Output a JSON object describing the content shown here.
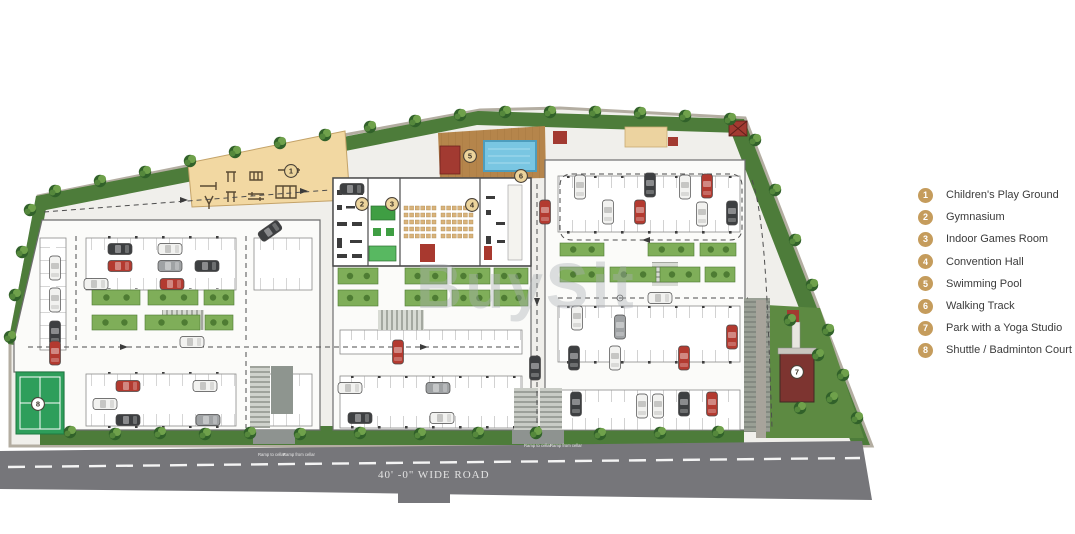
{
  "watermark": {
    "text": "BuySit"
  },
  "road": {
    "label": "40' -0\" WIDE ROAD",
    "ramp_to": "Ramp to cellar",
    "ramp_from": "Ramp from cellar"
  },
  "legend": {
    "circle_color": "#c59c5c",
    "items": [
      {
        "num": "1",
        "label": "Children's Play Ground"
      },
      {
        "num": "2",
        "label": "Gymnasium"
      },
      {
        "num": "3",
        "label": "Indoor Games Room"
      },
      {
        "num": "4",
        "label": "Convention Hall"
      },
      {
        "num": "5",
        "label": "Swimming Pool"
      },
      {
        "num": "6",
        "label": "Walking Track"
      },
      {
        "num": "7",
        "label": "Park with a Yoga Studio"
      },
      {
        "num": "8",
        "label": "Shuttle / Badminton Court"
      }
    ]
  },
  "plan": {
    "markers": [
      {
        "n": "1",
        "x": 291,
        "y": 171,
        "s": "g"
      },
      {
        "n": "2",
        "x": 362,
        "y": 204,
        "s": "g"
      },
      {
        "n": "3",
        "x": 392,
        "y": 204,
        "s": "g"
      },
      {
        "n": "4",
        "x": 472,
        "y": 205,
        "s": "g"
      },
      {
        "n": "5",
        "x": 470,
        "y": 156,
        "s": "g"
      },
      {
        "n": "6",
        "x": 521,
        "y": 176,
        "s": "g"
      },
      {
        "n": "7",
        "x": 797,
        "y": 372,
        "s": "w"
      },
      {
        "n": "8",
        "x": 38,
        "y": 404,
        "s": "w"
      }
    ],
    "cars": [
      [
        120,
        249,
        0,
        "dark"
      ],
      [
        120,
        266,
        0,
        "red"
      ],
      [
        96,
        284,
        0,
        "white"
      ],
      [
        170,
        249,
        0,
        "white"
      ],
      [
        170,
        266,
        0,
        "gray"
      ],
      [
        207,
        266,
        0,
        "dark"
      ],
      [
        172,
        284,
        0,
        "red"
      ],
      [
        55,
        268,
        90,
        "white"
      ],
      [
        55,
        300,
        90,
        "white"
      ],
      [
        55,
        333,
        90,
        "dark"
      ],
      [
        55,
        353,
        90,
        "red"
      ],
      [
        128,
        386,
        0,
        "red"
      ],
      [
        105,
        404,
        0,
        "white"
      ],
      [
        128,
        420,
        0,
        "dark"
      ],
      [
        205,
        386,
        0,
        "white"
      ],
      [
        208,
        420,
        0,
        "gray"
      ],
      [
        270,
        231,
        -35,
        "dark"
      ],
      [
        192,
        342,
        0,
        "white"
      ],
      [
        352,
        189,
        0,
        "dark"
      ],
      [
        398,
        352,
        90,
        "red"
      ],
      [
        350,
        388,
        0,
        "white"
      ],
      [
        438,
        388,
        0,
        "gray"
      ],
      [
        360,
        418,
        0,
        "dark"
      ],
      [
        442,
        418,
        0,
        "white"
      ],
      [
        535,
        368,
        90,
        "dark"
      ],
      [
        580,
        187,
        90,
        "white"
      ],
      [
        650,
        185,
        90,
        "dark"
      ],
      [
        685,
        187,
        90,
        "white"
      ],
      [
        707,
        186,
        90,
        "red"
      ],
      [
        545,
        212,
        90,
        "red"
      ],
      [
        608,
        212,
        90,
        "white"
      ],
      [
        640,
        212,
        90,
        "red"
      ],
      [
        702,
        214,
        90,
        "white"
      ],
      [
        732,
        213,
        90,
        "dark"
      ],
      [
        577,
        318,
        90,
        "white"
      ],
      [
        620,
        327,
        90,
        "gray"
      ],
      [
        615,
        358,
        90,
        "white"
      ],
      [
        574,
        358,
        90,
        "dark"
      ],
      [
        684,
        358,
        90,
        "red"
      ],
      [
        732,
        337,
        90,
        "red"
      ],
      [
        660,
        298,
        0,
        "white"
      ],
      [
        576,
        404,
        90,
        "dark"
      ],
      [
        642,
        406,
        90,
        "white"
      ],
      [
        658,
        406,
        90,
        "white"
      ],
      [
        684,
        404,
        90,
        "dark"
      ],
      [
        712,
        404,
        90,
        "red"
      ]
    ],
    "trees": [
      [
        55,
        191
      ],
      [
        100,
        181
      ],
      [
        145,
        172
      ],
      [
        190,
        161
      ],
      [
        235,
        152
      ],
      [
        280,
        143
      ],
      [
        325,
        135
      ],
      [
        370,
        127
      ],
      [
        415,
        121
      ],
      [
        460,
        115
      ],
      [
        505,
        112
      ],
      [
        550,
        112
      ],
      [
        595,
        112
      ],
      [
        640,
        113
      ],
      [
        685,
        116
      ],
      [
        730,
        119
      ],
      [
        30,
        210
      ],
      [
        22,
        252
      ],
      [
        15,
        295
      ],
      [
        10,
        337
      ],
      [
        755,
        140
      ],
      [
        775,
        190
      ],
      [
        795,
        240
      ],
      [
        812,
        285
      ],
      [
        828,
        330
      ],
      [
        843,
        375
      ],
      [
        857,
        418
      ],
      [
        790,
        320
      ],
      [
        818,
        355
      ],
      [
        800,
        408
      ],
      [
        832,
        398
      ],
      [
        70,
        432
      ],
      [
        115,
        434
      ],
      [
        160,
        433
      ],
      [
        205,
        434
      ],
      [
        250,
        433
      ],
      [
        300,
        434
      ],
      [
        360,
        433
      ],
      [
        420,
        434
      ],
      [
        478,
        433
      ],
      [
        536,
        433
      ],
      [
        600,
        434
      ],
      [
        660,
        433
      ],
      [
        718,
        432
      ]
    ],
    "planters": [
      [
        92,
        290,
        48,
        15
      ],
      [
        148,
        290,
        50,
        15
      ],
      [
        204,
        290,
        30,
        15
      ],
      [
        92,
        315,
        45,
        15
      ],
      [
        145,
        315,
        55,
        15
      ],
      [
        205,
        315,
        28,
        15
      ],
      [
        338,
        268,
        40,
        16
      ],
      [
        338,
        290,
        40,
        16
      ],
      [
        405,
        268,
        42,
        16
      ],
      [
        452,
        268,
        38,
        16
      ],
      [
        494,
        268,
        34,
        16
      ],
      [
        405,
        290,
        42,
        16
      ],
      [
        452,
        290,
        38,
        16
      ],
      [
        494,
        290,
        34,
        16
      ],
      [
        560,
        243,
        44,
        13
      ],
      [
        648,
        243,
        46,
        13
      ],
      [
        700,
        243,
        36,
        13
      ],
      [
        560,
        267,
        44,
        15
      ],
      [
        610,
        267,
        46,
        15
      ],
      [
        660,
        267,
        40,
        15
      ],
      [
        705,
        267,
        30,
        15
      ]
    ],
    "chair_grids": [
      {
        "x": 404,
        "y": 206,
        "rows": 5,
        "cols": 6,
        "size": 4,
        "gx": 5.6,
        "gy": 7
      },
      {
        "x": 441,
        "y": 206,
        "rows": 5,
        "cols": 6,
        "size": 4,
        "gx": 5.6,
        "gy": 7
      }
    ]
  },
  "colors": {
    "legend_circle": "#c59c5c",
    "marker_gold": "#ecd49c",
    "road": "#76767a",
    "green_band": "#4d7c3a",
    "pool": "#79c6e2",
    "deck": "#b5854b",
    "play_area": "#f2d8a2",
    "court": "#2e9e5b",
    "studio": "#7d3430",
    "accent_red": "#a8392f"
  }
}
